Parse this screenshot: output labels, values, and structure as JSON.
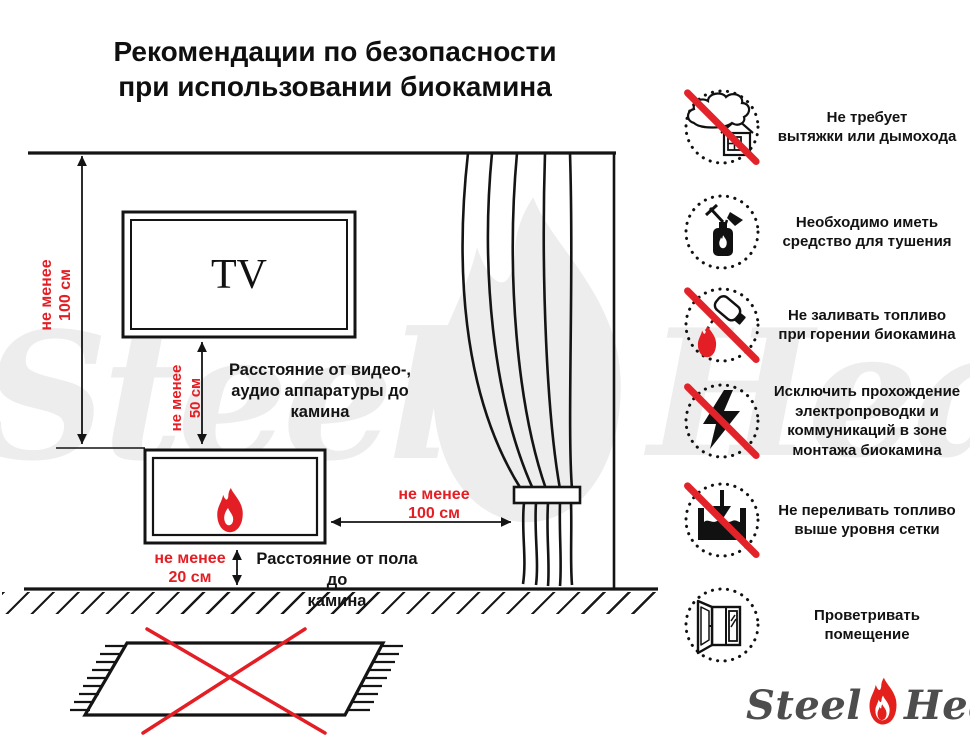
{
  "title": {
    "text": "Рекомендации по безопасности\nпри использовании биокамина"
  },
  "diagram": {
    "tv_label": "TV",
    "dim_wall_to_fireplace": "не менее\n100 см",
    "dim_tv_to_fireplace": "не менее\n50 см",
    "dim_fireplace_to_curtain": "не менее\n100 см",
    "dim_floor_to_fireplace": "не менее\n20 см",
    "caption_av_distance": "Расстояние от видео-,\nаудио аппаратуры до\nкамина",
    "caption_floor_distance": "Расстояние от пола до\nкамина"
  },
  "recommendations": [
    {
      "icon": "no-chimney-icon",
      "crossed": true,
      "text": "Не требует\nвытяжки или дымохода"
    },
    {
      "icon": "fire-extinguisher-icon",
      "crossed": false,
      "text": "Необходимо иметь\nсредство для тушения"
    },
    {
      "icon": "no-refueling-while-burning-icon",
      "crossed": true,
      "text": "Не заливать топливо\nпри горении биокамина"
    },
    {
      "icon": "no-electrical-wiring-icon",
      "crossed": true,
      "text": "Исключить прохождение\nэлектропроводки и\nкоммуникаций в зоне\nмонтажа биокамина"
    },
    {
      "icon": "no-overfilling-icon",
      "crossed": true,
      "text": "Не переливать топливо\nвыше уровня сетки"
    },
    {
      "icon": "open-window-icon",
      "crossed": false,
      "text": "Проветривать\nпомещение"
    }
  ],
  "watermark": {
    "steel": "Steel",
    "heat": "Heat"
  },
  "logo": {
    "steel": "Steel",
    "heat": "Heat"
  },
  "colors": {
    "accent_red": "#e31e24",
    "ink": "#141414",
    "logo_gray": "#4d4d4d",
    "watermark_gray": "#ededed"
  }
}
